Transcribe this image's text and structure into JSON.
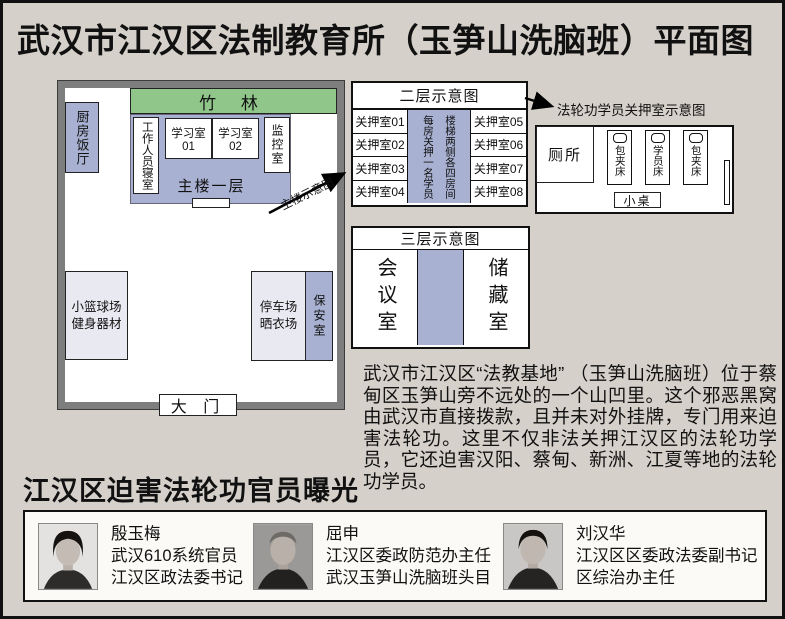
{
  "title": "武汉市江汉区法制教育所（玉笋山洗脑班）平面图",
  "colors": {
    "accent_blue": "#a8b1d1",
    "accent_green": "#90c689",
    "room_gray": "#e9e9f1",
    "wall_gray": "#7e7e7e",
    "background": "#d6d0ca"
  },
  "compound": {
    "bamboo": "竹  林",
    "kitchen": "厨房饭厅",
    "staff_dorm": "工作人员寝室",
    "study1": "学习室01",
    "study2": "学习室02",
    "monitor": "监控室",
    "floor1": "主楼一层",
    "arrow_label": "主楼示意图",
    "basketball_line1": "小篮球场",
    "basketball_line2": "健身器材",
    "parking_line1": "停车场",
    "parking_line2": "晒衣场",
    "security": "保安室",
    "gate": "大 门"
  },
  "floor2": {
    "title": "二层示意图",
    "left_rooms": [
      "关押室01",
      "关押室02",
      "关押室03",
      "关押室04"
    ],
    "right_rooms": [
      "关押室05",
      "关押室06",
      "关押室07",
      "关押室08"
    ],
    "stairs_note_right": "楼梯两侧各四房间",
    "stairs_note_left": "每房关押一名学员"
  },
  "cell": {
    "title": "法轮功学员关押室示意图",
    "toilet": "厕所",
    "bed1": "包夹床",
    "bed2": "学员床",
    "bed3": "包夹床",
    "table": "小桌"
  },
  "floor3": {
    "title": "三层示意图",
    "meeting": "会议室",
    "storage": "储藏室"
  },
  "description": "武汉市江汉区“法教基地” （玉笋山洗脑班）位于蔡甸区玉笋山旁不远处的一个山凹里。这个邪恶黑窝由武汉市直接拨款，且并未对外挂牌，专门用来迫害法轮功。这里不仅非法关押江汉区的法轮功学员，它还迫害汉阳、蔡甸、新洲、江夏等地的法轮功学员。",
  "officials_section": {
    "heading": "江汉区迫害法轮功官员曝光",
    "officials": [
      {
        "name": "殷玉梅",
        "line1": "武汉610系统官员",
        "line2": "江汉区政法委书记"
      },
      {
        "name": "屈申",
        "line1": "江汉区委政防范办主任",
        "line2": "武汉玉笋山洗脑班头目"
      },
      {
        "name": "刘汉华",
        "line1": "江汉区区委政法委副书记",
        "line2": "区综治办主任"
      }
    ]
  }
}
